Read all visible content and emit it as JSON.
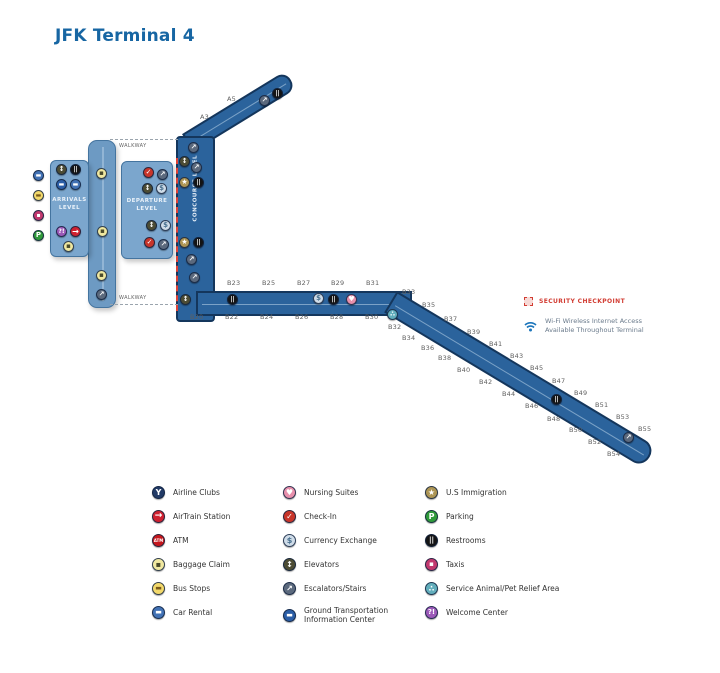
{
  "title": "JFK Terminal 4",
  "colors": {
    "title_blue": "#1766a3",
    "corridor_fill": "#2b639c",
    "corridor_border": "#14365c",
    "block_fill": "#7ba6cd",
    "security_red": "#d23c32",
    "wifi_blue": "#1b75bb"
  },
  "map": {
    "labels": {
      "arrivals": "ARRIVALS LEVEL",
      "departure": "DEPARTURE LEVEL",
      "concourse": "CONCOURSE LEVEL",
      "walkway_top": "WALKWAY",
      "walkway_bottom": "WALKWAY"
    },
    "gates": [
      {
        "label": "A3",
        "x": 200,
        "y": 113
      },
      {
        "label": "A5",
        "x": 227,
        "y": 95
      },
      {
        "label": "B23",
        "x": 227,
        "y": 279
      },
      {
        "label": "B25",
        "x": 262,
        "y": 279
      },
      {
        "label": "B27",
        "x": 297,
        "y": 279
      },
      {
        "label": "B29",
        "x": 331,
        "y": 279
      },
      {
        "label": "B31",
        "x": 366,
        "y": 279
      },
      {
        "label": "B20",
        "x": 190,
        "y": 313
      },
      {
        "label": "B22",
        "x": 225,
        "y": 313
      },
      {
        "label": "B24",
        "x": 260,
        "y": 313
      },
      {
        "label": "B26",
        "x": 295,
        "y": 313
      },
      {
        "label": "B28",
        "x": 330,
        "y": 313
      },
      {
        "label": "B30",
        "x": 365,
        "y": 313
      },
      {
        "label": "B33",
        "x": 402,
        "y": 288
      },
      {
        "label": "B35",
        "x": 422,
        "y": 301
      },
      {
        "label": "B37",
        "x": 444,
        "y": 315
      },
      {
        "label": "B39",
        "x": 467,
        "y": 328
      },
      {
        "label": "B41",
        "x": 489,
        "y": 340
      },
      {
        "label": "B43",
        "x": 510,
        "y": 352
      },
      {
        "label": "B45",
        "x": 530,
        "y": 364
      },
      {
        "label": "B47",
        "x": 552,
        "y": 377
      },
      {
        "label": "B49",
        "x": 574,
        "y": 389
      },
      {
        "label": "B51",
        "x": 595,
        "y": 401
      },
      {
        "label": "B53",
        "x": 616,
        "y": 413
      },
      {
        "label": "B55",
        "x": 638,
        "y": 425
      },
      {
        "label": "B32",
        "x": 388,
        "y": 323
      },
      {
        "label": "B34",
        "x": 402,
        "y": 334
      },
      {
        "label": "B36",
        "x": 421,
        "y": 344
      },
      {
        "label": "B38",
        "x": 438,
        "y": 354
      },
      {
        "label": "B40",
        "x": 457,
        "y": 366
      },
      {
        "label": "B42",
        "x": 479,
        "y": 378
      },
      {
        "label": "B44",
        "x": 502,
        "y": 390
      },
      {
        "label": "B46",
        "x": 525,
        "y": 402
      },
      {
        "label": "B48",
        "x": 547,
        "y": 415
      },
      {
        "label": "B50",
        "x": 569,
        "y": 426
      },
      {
        "label": "B52",
        "x": 588,
        "y": 438
      },
      {
        "label": "B54",
        "x": 607,
        "y": 450
      }
    ],
    "icons": [
      {
        "t": "car-rental",
        "x": 33,
        "y": 170
      },
      {
        "t": "bus-stops",
        "x": 33,
        "y": 190
      },
      {
        "t": "taxis",
        "x": 33,
        "y": 210
      },
      {
        "t": "parking",
        "x": 33,
        "y": 230
      },
      {
        "t": "elevators",
        "x": 56,
        "y": 164
      },
      {
        "t": "restrooms",
        "x": 70,
        "y": 164
      },
      {
        "t": "ground-transport",
        "x": 56,
        "y": 179
      },
      {
        "t": "car-rental",
        "x": 70,
        "y": 179
      },
      {
        "t": "welcome-center",
        "x": 56,
        "y": 226
      },
      {
        "t": "airtrain",
        "x": 70,
        "y": 226
      },
      {
        "t": "baggage-claim",
        "x": 63,
        "y": 241
      },
      {
        "t": "baggage-claim",
        "x": 96,
        "y": 168
      },
      {
        "t": "baggage-claim",
        "x": 97,
        "y": 226
      },
      {
        "t": "baggage-claim",
        "x": 96,
        "y": 270
      },
      {
        "t": "escalators",
        "x": 96,
        "y": 289
      },
      {
        "t": "check-in",
        "x": 143,
        "y": 167
      },
      {
        "t": "escalators",
        "x": 157,
        "y": 169
      },
      {
        "t": "elevators",
        "x": 142,
        "y": 183
      },
      {
        "t": "currency-exchange",
        "x": 156,
        "y": 183
      },
      {
        "t": "elevators",
        "x": 146,
        "y": 220
      },
      {
        "t": "currency-exchange",
        "x": 160,
        "y": 220
      },
      {
        "t": "check-in",
        "x": 144,
        "y": 237
      },
      {
        "t": "escalators",
        "x": 158,
        "y": 239
      },
      {
        "t": "escalators",
        "x": 188,
        "y": 142
      },
      {
        "t": "elevators",
        "x": 179,
        "y": 156
      },
      {
        "t": "escalators",
        "x": 191,
        "y": 162
      },
      {
        "t": "us-immigration",
        "x": 179,
        "y": 177
      },
      {
        "t": "restrooms",
        "x": 193,
        "y": 177
      },
      {
        "t": "us-immigration",
        "x": 179,
        "y": 237
      },
      {
        "t": "restrooms",
        "x": 193,
        "y": 237
      },
      {
        "t": "escalators",
        "x": 186,
        "y": 254
      },
      {
        "t": "escalators",
        "x": 189,
        "y": 272
      },
      {
        "t": "elevators",
        "x": 180,
        "y": 294
      },
      {
        "t": "escalators",
        "x": 259,
        "y": 95
      },
      {
        "t": "restrooms",
        "x": 272,
        "y": 88
      },
      {
        "t": "restrooms",
        "x": 227,
        "y": 294
      },
      {
        "t": "currency-exchange",
        "x": 313,
        "y": 293
      },
      {
        "t": "restrooms",
        "x": 328,
        "y": 294
      },
      {
        "t": "nursing-suites",
        "x": 346,
        "y": 294
      },
      {
        "t": "service-animal",
        "x": 387,
        "y": 309
      },
      {
        "t": "restrooms",
        "x": 551,
        "y": 394
      },
      {
        "t": "escalators",
        "x": 623,
        "y": 432
      }
    ]
  },
  "icon_defs": {
    "airline-clubs": {
      "glyph": "Y",
      "bg": "#223a66",
      "fg": "#ffffff",
      "scale": 0.6
    },
    "airtrain": {
      "glyph": "→",
      "bg": "#cf2030",
      "fg": "#ffffff",
      "scale": 0.7
    },
    "atm": {
      "glyph": "ATM",
      "bg": "#c6161c",
      "fg": "#ffffff",
      "scale": 0.3
    },
    "baggage-claim": {
      "glyph": "▪",
      "bg": "#f0e8a0",
      "fg": "#4a4a2a",
      "scale": 0.6
    },
    "bus-stops": {
      "glyph": "▬",
      "bg": "#f3d96b",
      "fg": "#7a5a1a",
      "scale": 0.5
    },
    "car-rental": {
      "glyph": "▬",
      "bg": "#4272b5",
      "fg": "#ffffff",
      "scale": 0.5
    },
    "nursing-suites": {
      "glyph": "♥",
      "bg": "#e890ac",
      "fg": "#ffffff",
      "scale": 0.6
    },
    "check-in": {
      "glyph": "✓",
      "bg": "#c8352a",
      "fg": "#ffffff",
      "scale": 0.6
    },
    "currency-exchange": {
      "glyph": "$",
      "bg": "#cfdce8",
      "fg": "#49708f",
      "scale": 0.65
    },
    "elevators": {
      "glyph": "↕",
      "bg": "#4c4c34",
      "fg": "#ffffff",
      "scale": 0.65
    },
    "escalators": {
      "glyph": "↗",
      "bg": "#5b697d",
      "fg": "#ffffff",
      "scale": 0.65
    },
    "ground-transport": {
      "glyph": "▬",
      "bg": "#2b5ea7",
      "fg": "#ffffff",
      "scale": 0.5
    },
    "us-immigration": {
      "glyph": "★",
      "bg": "#ad9554",
      "fg": "#ffffff",
      "scale": 0.6
    },
    "parking": {
      "glyph": "P",
      "bg": "#2f9a3a",
      "fg": "#ffffff",
      "scale": 0.65
    },
    "restrooms": {
      "glyph": "||",
      "bg": "#141414",
      "fg": "#ffffff",
      "scale": 0.5
    },
    "taxis": {
      "glyph": "▪",
      "bg": "#c2386e",
      "fg": "#ffffff",
      "scale": 0.55
    },
    "service-animal": {
      "glyph": "∴",
      "bg": "#62aebc",
      "fg": "#ffffff",
      "scale": 0.65
    },
    "welcome-center": {
      "glyph": "?!",
      "bg": "#9c59b8",
      "fg": "#ffffff",
      "scale": 0.5
    }
  },
  "legend": {
    "columns": [
      [
        {
          "icon": "airline-clubs",
          "label": "Airline Clubs"
        },
        {
          "icon": "airtrain",
          "label": "AirTrain Station"
        },
        {
          "icon": "atm",
          "label": "ATM"
        },
        {
          "icon": "baggage-claim",
          "label": "Baggage Claim"
        },
        {
          "icon": "bus-stops",
          "label": "Bus Stops"
        },
        {
          "icon": "car-rental",
          "label": "Car Rental"
        }
      ],
      [
        {
          "icon": "nursing-suites",
          "label": "Nursing Suites"
        },
        {
          "icon": "check-in",
          "label": "Check-In"
        },
        {
          "icon": "currency-exchange",
          "label": "Currency Exchange"
        },
        {
          "icon": "elevators",
          "label": "Elevators"
        },
        {
          "icon": "escalators",
          "label": "Escalators/Stairs"
        },
        {
          "icon": "ground-transport",
          "label": "Ground Transportation\nInformation Center"
        }
      ],
      [
        {
          "icon": "us-immigration",
          "label": "U.S Immigration"
        },
        {
          "icon": "parking",
          "label": "Parking"
        },
        {
          "icon": "restrooms",
          "label": "Restrooms"
        },
        {
          "icon": "taxis",
          "label": "Taxis"
        },
        {
          "icon": "service-animal",
          "label": "Service Animal/Pet Relief Area"
        },
        {
          "icon": "welcome-center",
          "label": "Welcome Center"
        }
      ]
    ]
  },
  "side_legend": {
    "security": "SECURITY CHECKPOINT",
    "wifi_line1": "Wi-Fi Wireless Internet Access",
    "wifi_line2": "Available Throughout Terminal"
  }
}
